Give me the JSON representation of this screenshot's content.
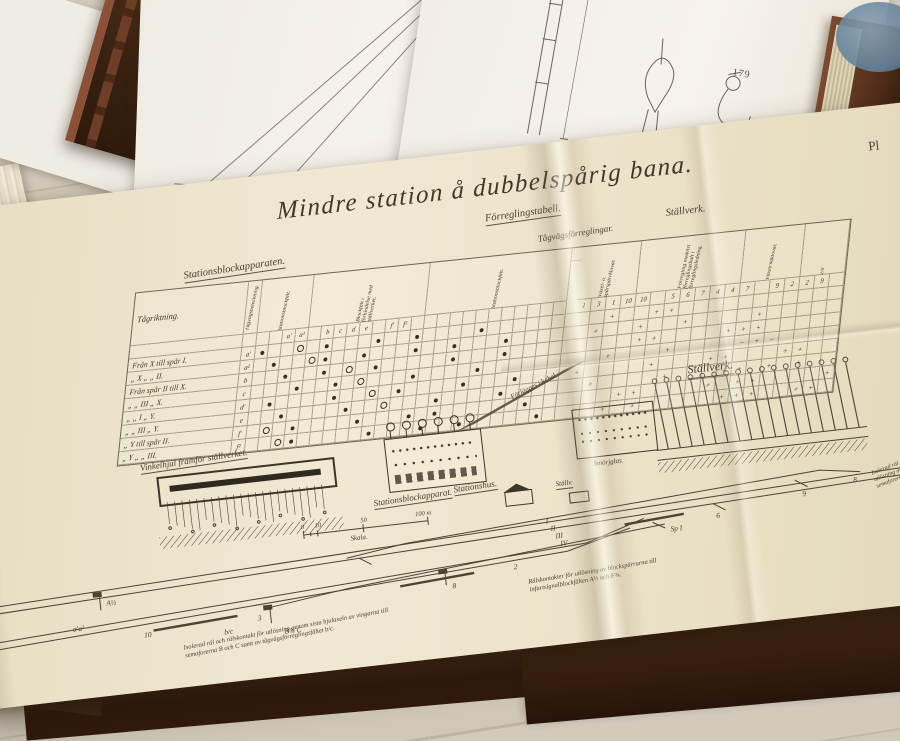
{
  "scene": {
    "wood_color": "#ccc4b3",
    "plate_color": "#ece2c8",
    "ink_color": "#45402f",
    "leather_color": "#4a2c1b"
  },
  "upper_book": {
    "page_number": "179"
  },
  "plate": {
    "corner_label": "Pl",
    "title": "Mindre station å dubbelspårig bana.",
    "headings": {
      "stationsblockapparaten": "Stationsblockapparaten.",
      "forreglingstabell": "Förreglingstabell.",
      "tagvagsforreglingar": "Tågvägsförreglingar.",
      "stallverk": "Ställverk."
    },
    "table": {
      "corner": "Tågriktning.",
      "rotcol": "Tågvägsbeteckning.",
      "groups_left": [
        {
          "text": "Stationsblockfält.",
          "span": 4
        },
        {
          "text": "Blockfält i förbindelse med ställverket.",
          "span": 9
        },
        {
          "text": "Stationsblockfält.",
          "span": 11
        }
      ],
      "groups_right": [
        {
          "text": "Växel- o. spårspärrklovar.",
          "span": 4
        },
        {
          "text": "Förregling medelst förreglingsbult i förreglingsledning.",
          "span": 7
        },
        {
          "text": "Växelriktklovar.",
          "span": 4
        },
        {
          "text": "2/9",
          "span": 3
        }
      ],
      "letters_row": [
        "",
        "",
        "a′",
        "a²",
        "",
        "b",
        "c",
        "d",
        "e",
        "",
        "f′",
        "f²",
        "",
        "",
        "",
        "",
        "",
        "",
        "",
        "",
        "",
        "",
        "",
        ""
      ],
      "numbers_row": [
        "1",
        "3",
        "1",
        "10",
        "10",
        "",
        "5",
        "6",
        "7",
        "4",
        "4",
        "7",
        "",
        "9",
        "2",
        "2",
        "9",
        ""
      ],
      "rows": [
        {
          "label": "Från X till spår I.",
          "letter": "a′",
          "left": "d..o.d...d..d....d......",
          "right": "..+..++..........."
        },
        {
          "label": "„   X  „    „  II.",
          "letter": "a²",
          "left": ".d..od..d...d..d...d....",
          "right": ".+..+..+....+....."
        },
        {
          "label": "Från spår II till X.",
          "letter": "b",
          "left": "..d..d.o.d.....d...d....",
          "right": "....++....+++....."
        },
        {
          "label": "„    „  III  „  X.",
          "letter": "c",
          "left": "...d..d.o...d....d......",
          "right": "..+...+....-+-...."
        },
        {
          "label": "„    „  I   „  Y.",
          "letter": "d′",
          "left": ".d....d..o.d....d...d...",
          "right": "+....+...++...++.."
        },
        {
          "label": "„    „  III  „  Y.",
          "letter": "e",
          "left": "..d....d..o...d....d....",
          "right": ".+....+...++.+.+.."
        },
        {
          "label": "„  Y till spår II.",
          "letter": "f′",
          "left": ".o.d....d...d.d......d..",
          "right": "...++....+.++....+"
        },
        {
          "label": "„  Y  „    „  III.",
          "letter": "f²",
          "left": "..od.....d...d..d.....d.",
          "right": "..+.+.....+++..++."
        }
      ]
    },
    "drawings": {
      "vinkelhjul": "Vinkelhjul framför ställverket.",
      "blockapparat": "Stationsblockapparat.",
      "kabel": "Förlägges i kabel.",
      "stallverk": "Ställverk.",
      "smorjglas": "Smörjglas.",
      "stationshus": "Stationshus.",
      "stallv": "Ställv."
    },
    "scale": {
      "label": "Skala.",
      "ticks": [
        {
          "t": "0",
          "x": 340
        },
        {
          "t": "10",
          "x": 354
        },
        {
          "t": "50",
          "x": 400
        },
        {
          "t": "100 m",
          "x": 455
        }
      ]
    },
    "track_labels": [
      {
        "t": "a′a²",
        "x": 100,
        "y": 432
      },
      {
        "t": "A½",
        "x": 136,
        "y": 410
      },
      {
        "t": "10",
        "x": 170,
        "y": 446
      },
      {
        "t": "b/c",
        "x": 250,
        "y": 452
      },
      {
        "t": "3",
        "x": 285,
        "y": 442
      },
      {
        "t": "B¾ C",
        "x": 310,
        "y": 458
      },
      {
        "t": "8",
        "x": 482,
        "y": 432
      },
      {
        "t": "2",
        "x": 545,
        "y": 420
      },
      {
        "t": "I",
        "x": 582,
        "y": 378
      },
      {
        "t": "II",
        "x": 586,
        "y": 386
      },
      {
        "t": "III",
        "x": 590,
        "y": 394
      },
      {
        "t": "IV",
        "x": 594,
        "y": 402
      },
      {
        "t": "Sp I",
        "x": 705,
        "y": 400
      },
      {
        "t": "6",
        "x": 752,
        "y": 392
      },
      {
        "t": "9",
        "x": 840,
        "y": 380
      },
      {
        "t": "8",
        "x": 892,
        "y": 372
      }
    ],
    "annotations": {
      "left": "Isolerad räl och rälskontakt för utlösning genom sista hjulaxeln av vingarna till semaforerna B och C samt av tågvägsförreglingsfältet b/c.",
      "center": "Rälskontakter för utlösning av blockspärrarna till infartsignalblockfälten A½ och F¾.",
      "right": "Isolerad räl och rälskontakt för utlösning av vingarna till semaforerna."
    },
    "ghost_text": "— X"
  },
  "generators": {
    "cables": 7,
    "wires": 22,
    "levers": 17
  }
}
